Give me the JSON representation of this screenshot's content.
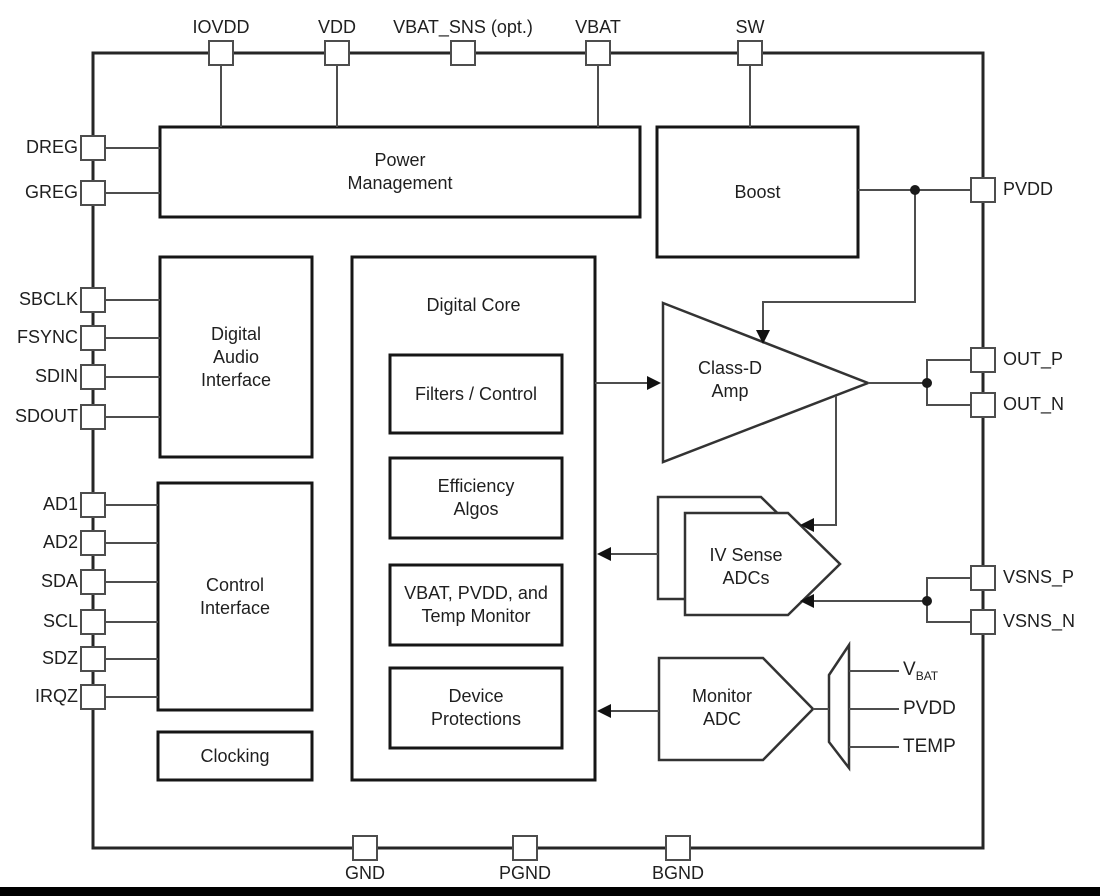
{
  "pins": {
    "top": [
      "IOVDD",
      "VDD",
      "VBAT_SNS (opt.)",
      "VBAT",
      "SW"
    ],
    "left": [
      "DREG",
      "GREG",
      "SBCLK",
      "FSYNC",
      "SDIN",
      "SDOUT",
      "AD1",
      "AD2",
      "SDA",
      "SCL",
      "SDZ",
      "IRQZ"
    ],
    "right": [
      "PVDD",
      "OUT_P",
      "OUT_N",
      "VSNS_P",
      "VSNS_N"
    ],
    "bottom": [
      "GND",
      "PGND",
      "BGND"
    ]
  },
  "blocks": {
    "power_management": "Power\nManagement",
    "boost": "Boost",
    "digital_audio_interface": "Digital\nAudio\nInterface",
    "control_interface": "Control\nInterface",
    "clocking": "Clocking",
    "digital_core": "Digital Core",
    "filters_control": "Filters / Control",
    "efficiency_algos": "Efficiency\nAlgos",
    "vbat_pvdd_temp_monitor": "VBAT, PVDD, and\nTemp Monitor",
    "device_protections": "Device\nProtections",
    "class_d_amp": "Class-D\nAmp",
    "iv_sense_adcs": "IV Sense\nADCs",
    "monitor_adc": "Monitor\nADC"
  },
  "monitor_mux_outputs": {
    "vbat_main": "V",
    "vbat_sub": "BAT",
    "pvdd": "PVDD",
    "temp": "TEMP"
  },
  "colors": {
    "background": "#ffffff",
    "block_stroke": "#1a1a1a",
    "wire": "#4d4d4d",
    "text": "#1f1f1f",
    "footer_bar": "#000000"
  }
}
